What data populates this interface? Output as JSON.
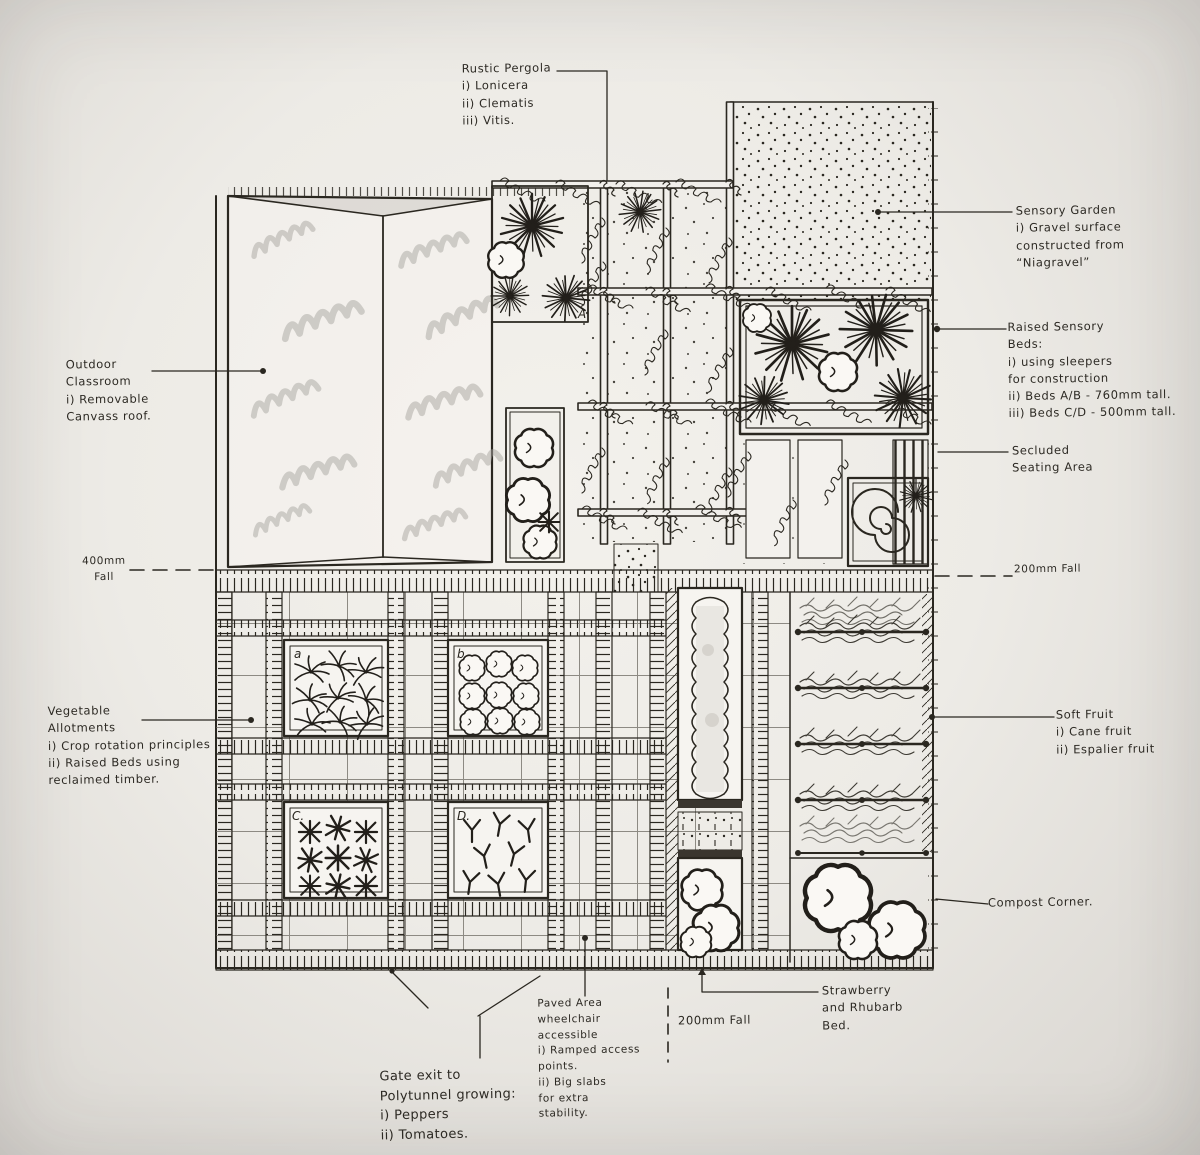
{
  "photo": {
    "paper_color": "#eceae5",
    "ink_color": "#2a2720",
    "pencil_color": "#a8a5a0"
  },
  "annotations": {
    "rustic_pergola": {
      "lines": [
        "Rustic Pergola",
        "i) Lonicera",
        "ii) Clematis",
        "iii) Vitis."
      ]
    },
    "sensory_garden": {
      "lines": [
        "Sensory Garden",
        "i) Gravel surface",
        "constructed from",
        "“Niagravel”"
      ]
    },
    "raised_sensory_beds": {
      "lines": [
        "Raised Sensory",
        "Beds:",
        "i) using sleepers",
        "for construction",
        "ii) Beds A/B - 760mm tall.",
        "iii) Beds C/D - 500mm tall."
      ]
    },
    "secluded_seating": {
      "lines": [
        "Secluded",
        "Seating Area"
      ]
    },
    "outdoor_classroom": {
      "lines": [
        "Outdoor",
        "Classroom",
        "i) Removable",
        "Canvass roof."
      ]
    },
    "fall_left": {
      "lines": [
        "400mm",
        "Fall"
      ]
    },
    "fall_right": {
      "lines": [
        "200mm Fall"
      ]
    },
    "vegetable_allotments": {
      "lines": [
        "Vegetable",
        "Allotments",
        "i) Crop rotation principles",
        "ii) Raised Beds using",
        "reclaimed timber."
      ]
    },
    "soft_fruit": {
      "lines": [
        "Soft Fruit",
        "i) Cane fruit",
        "ii) Espalier fruit"
      ]
    },
    "compost_corner": {
      "lines": [
        "Compost Corner."
      ]
    },
    "strawberry_bed": {
      "lines": [
        "Strawberry",
        "and Rhubarb",
        "Bed."
      ]
    },
    "fall_bottom": {
      "lines": [
        "200mm Fall"
      ]
    },
    "paved_area": {
      "lines": [
        "Paved Area",
        "wheelchair",
        "accessible",
        "i) Ramped access",
        "points.",
        "ii) Big slabs",
        "for extra",
        "stability."
      ]
    },
    "gate_exit": {
      "lines": [
        "Gate exit to",
        "Polytunnel growing:",
        "i) Peppers",
        "ii) Tomatoes."
      ]
    }
  },
  "bed_labels": {
    "a": "a",
    "b": "b",
    "c": "C.",
    "d": "D.",
    "top": "A"
  }
}
